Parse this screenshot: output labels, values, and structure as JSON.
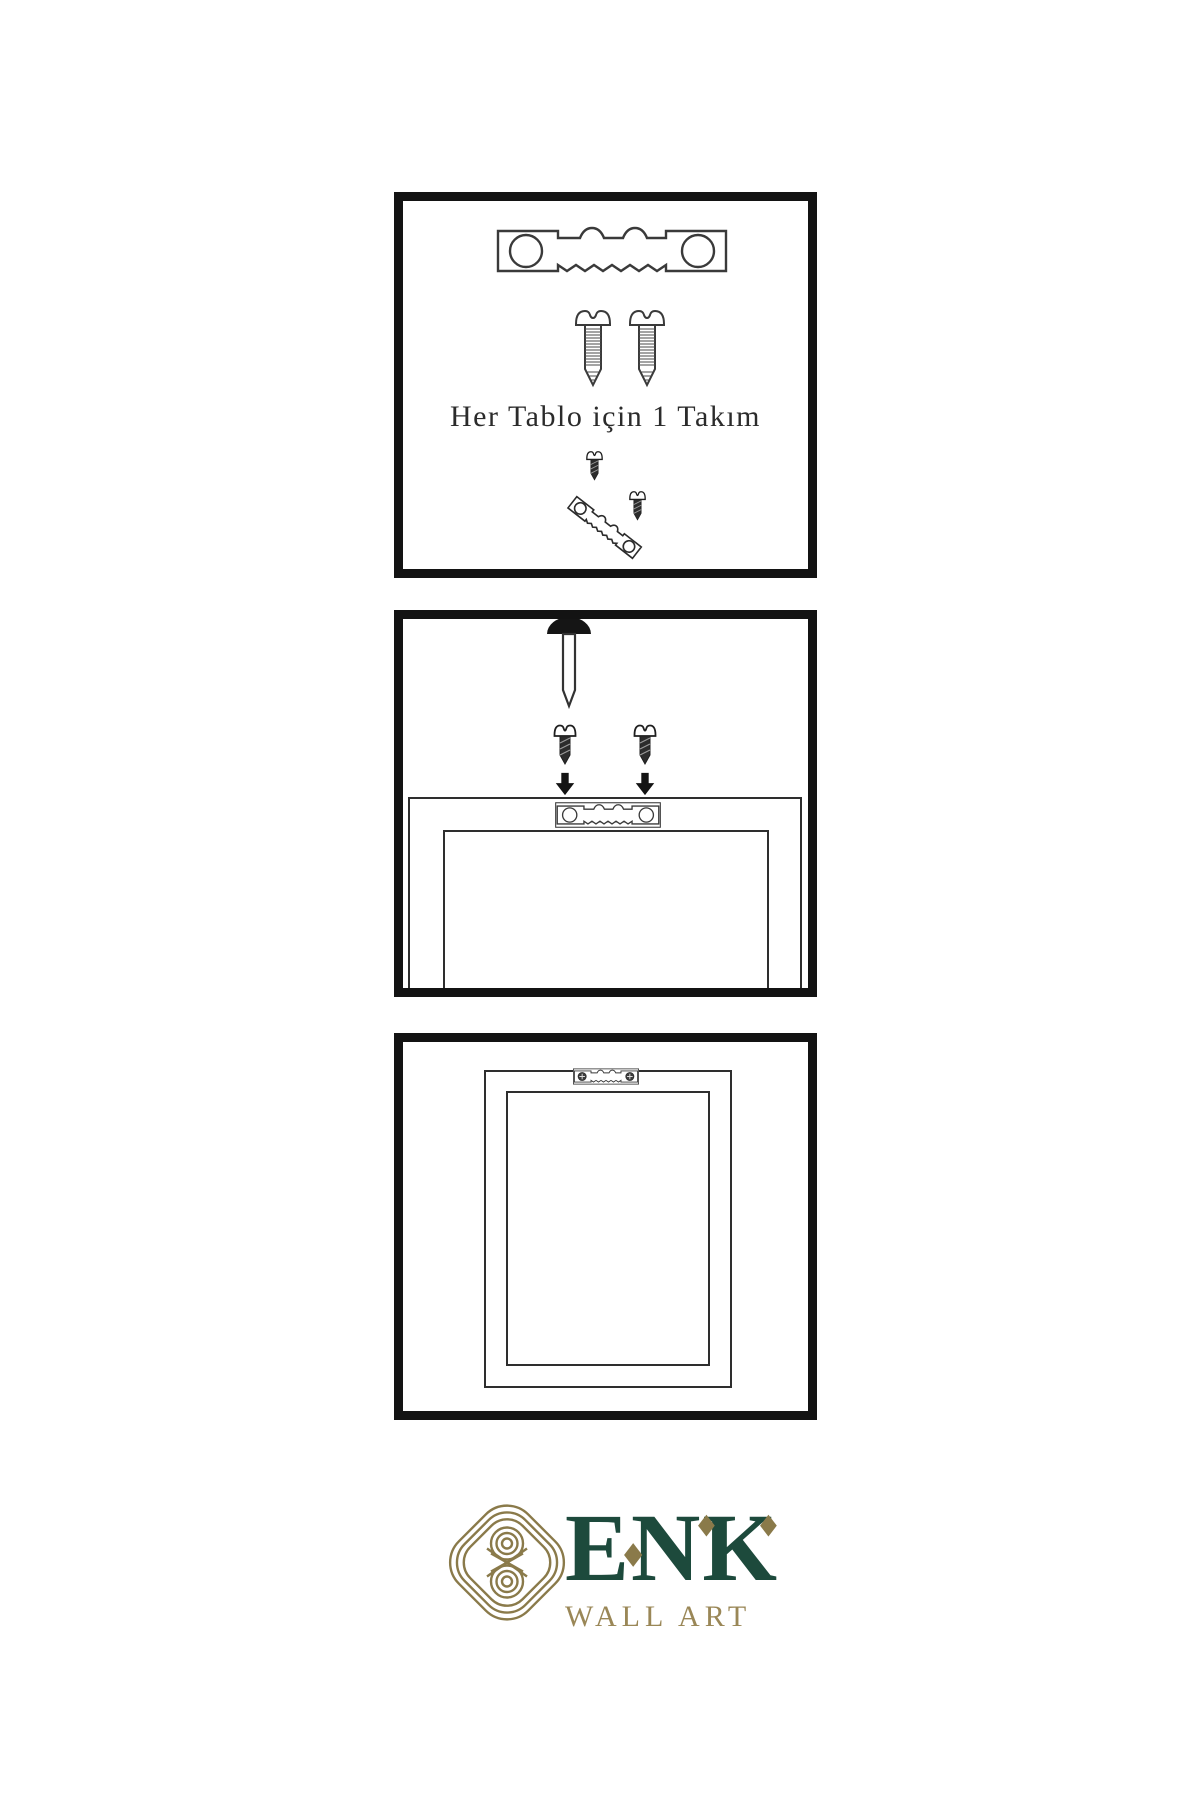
{
  "page": {
    "background": "#ffffff",
    "language": "tr"
  },
  "colors": {
    "border": "#131313",
    "ink": "#3a3a3a",
    "dark": "#1a1a1a",
    "green": "#1d4a3c",
    "gold": "#9a8757",
    "gold_dark": "#8a7a4a"
  },
  "brand": {
    "name": "ENK",
    "subtitle": "WALL ART"
  },
  "icons": {
    "sawtooth-hanger-icon": "outlined metal plate, two round holes, sawtooth bottom edge",
    "screw-outline-icon": "threaded screw, dome slotted head, outline drawing",
    "screw-dark-icon": "short dark screw, dome slotted head",
    "screw-into-hanger-icon": "dark screws driven into tilted sawtooth hanger",
    "wall-nail-icon": "nail in wall pointing down, dark dome head",
    "down-arrow-icon": "solid black downward arrow",
    "frame-back-icon": "nested rectangles, back of picture frame",
    "mounted-sawtooth-hanger-icon": "sawtooth hanger fixed with two cross-head screws",
    "knot-emblem-icon": "interlaced gold knot in rounded diamond",
    "diamond-accent-icon": "◆"
  },
  "steps": [
    {
      "index": 1,
      "caption": "Her Tablo için 1 Takım",
      "items": [
        "sawtooth-hanger-icon",
        "screw-outline-icon",
        "screw-outline-icon",
        "screw-into-hanger-icon"
      ]
    },
    {
      "index": 2,
      "caption": "",
      "items": [
        "wall-nail-icon",
        "screw-dark-icon",
        "down-arrow-icon",
        "screw-dark-icon",
        "down-arrow-icon",
        "frame-back-icon",
        "sawtooth-hanger-icon"
      ]
    },
    {
      "index": 3,
      "caption": "",
      "items": [
        "frame-back-icon",
        "mounted-sawtooth-hanger-icon"
      ]
    }
  ]
}
